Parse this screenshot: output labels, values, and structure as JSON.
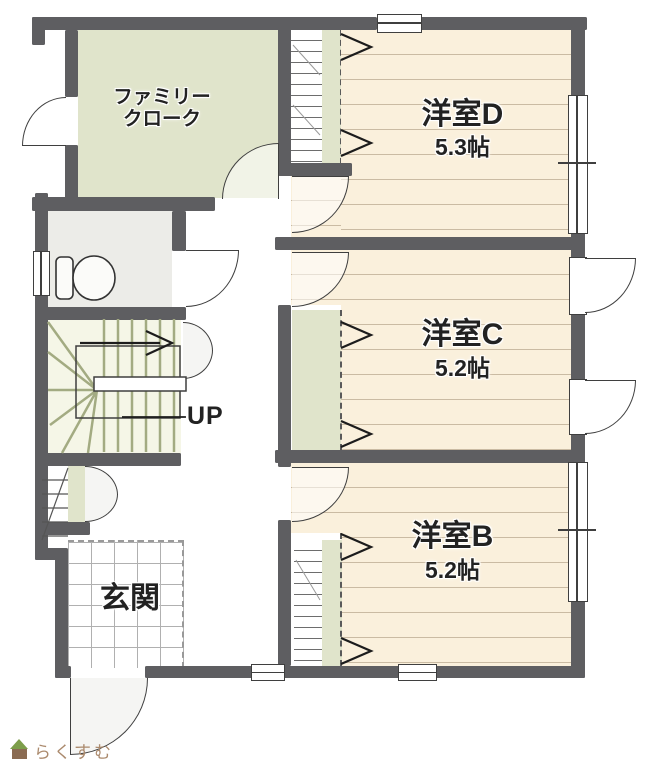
{
  "title": "2F間取り図",
  "rooms": {
    "family_cloak": {
      "line1": "ファミリー",
      "line2": "クローク"
    },
    "room_d": {
      "name": "洋室D",
      "area": "5.3帖"
    },
    "room_c": {
      "name": "洋室C",
      "area": "5.2帖"
    },
    "room_b": {
      "name": "洋室B",
      "area": "5.2帖"
    },
    "entrance": {
      "name": "玄関"
    },
    "stairs": {
      "direction_label": "UP"
    }
  },
  "branding": {
    "logo_text": "らくすむ"
  },
  "colors": {
    "wall": "#5e5e61",
    "outline": "#3f3f3f",
    "room_floor": "#faf0dc",
    "floor_line": "#b59a78",
    "closet_green": "#e0e4cb",
    "stairs_floor": "#f5f6e7",
    "toilet_floor": "#ecece8",
    "tile_grid": "#b0b0b0",
    "tread": "#a3ab82",
    "text": "#222222",
    "logo_brown": "#ab8a6d",
    "logo_green": "#7d9e4a",
    "logo_body": "#8a6b52",
    "door_fill": "#f5f5f3"
  }
}
